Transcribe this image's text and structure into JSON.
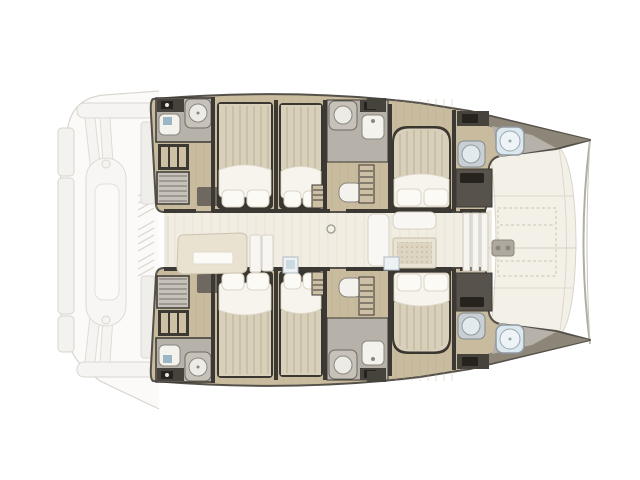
{
  "boat": {
    "view": "top-down-floor-plan",
    "vessel_type": "sailing-catamaran",
    "orientation": "bow-right-stern-left",
    "hull_count": 2,
    "double_bed_cabins_visible": 6,
    "bathrooms_visible_per_hull": 3,
    "bow_showers": 2,
    "dinghy_on_stern_davits": true
  },
  "regions": {
    "stern": {
      "features": [
        "swim-platform",
        "transom-beams",
        "davit-arms",
        "dinghy",
        "cockpit-louvers"
      ]
    },
    "port_hull": {
      "position": "top",
      "compartments": [
        "aft-bathroom",
        "wardrobe",
        "companionway-steps",
        "aft-double-cabin",
        "mid-double-cabin",
        "mid-bathroom",
        "forward-double-cabin",
        "forward-head",
        "bow-shower"
      ]
    },
    "starboard_hull": {
      "position": "bottom",
      "mirror_of": "port_hull"
    },
    "saloon": {
      "features": [
        "galley-sofa",
        "galley-counters",
        "fridge",
        "mast-foot",
        "dinette-table",
        "dinette-benches",
        "foredeck-door"
      ]
    },
    "foredeck": {
      "features": [
        "trampoline-dashed-outline",
        "anchor-windlass",
        "anchor-chain-line",
        "bow-crossbeam",
        "deck-seams"
      ]
    }
  },
  "palette": {
    "wall": "#3C3833",
    "hull_outline": "#54504A",
    "hull_floor": "#C8BB9E",
    "hull_floor_grain": "#BBAD8F",
    "saloon_floor": "#F1EDE3",
    "saloon_grain": "#E6E0D2",
    "foredeck": "#F3F0E8",
    "foredeck_line": "#D9D4C7",
    "bath_floor": "#B7B2A9",
    "shower_pan": "#C6C2B9",
    "fixture_white": "#F4F2EC",
    "fixture_ring": "#8A867E",
    "counter_dark": "#46423C",
    "cabinet_dark": "#57524B",
    "black_item": "#26231F",
    "toilet_blue": "#9DB6C4",
    "bow_shower_fill": "#DCE8ED",
    "bow_shower_ring": "#8E9AA2",
    "bed_frame": "#3A3630",
    "mattress": "#D8D0BB",
    "mattress_stripe": "#C9C0A8",
    "duvet": "#F6F4ED",
    "pillow": "#FBFAF5",
    "pillow_edge": "#DCD6C8",
    "wardrobe_beige": "#CDC0A5",
    "gunwale": "#8D8578",
    "cream_sofa": "#EAE2D1",
    "white_furniture": "#F8F7F3",
    "furniture_edge": "#D6D1C5",
    "table_top": "#E9E3D3",
    "table_dot": "#C1B8A0",
    "fridge_blue": "#CBD9E0",
    "ghost_line": "#D9D6D0",
    "ghost_fill": "#FBFAF9",
    "ghost_fill2": "#F3F2EF",
    "crossbeam": "#B3AEA3",
    "tramp_dash": "#C8C3B4",
    "windlass": "#AEA99F"
  }
}
